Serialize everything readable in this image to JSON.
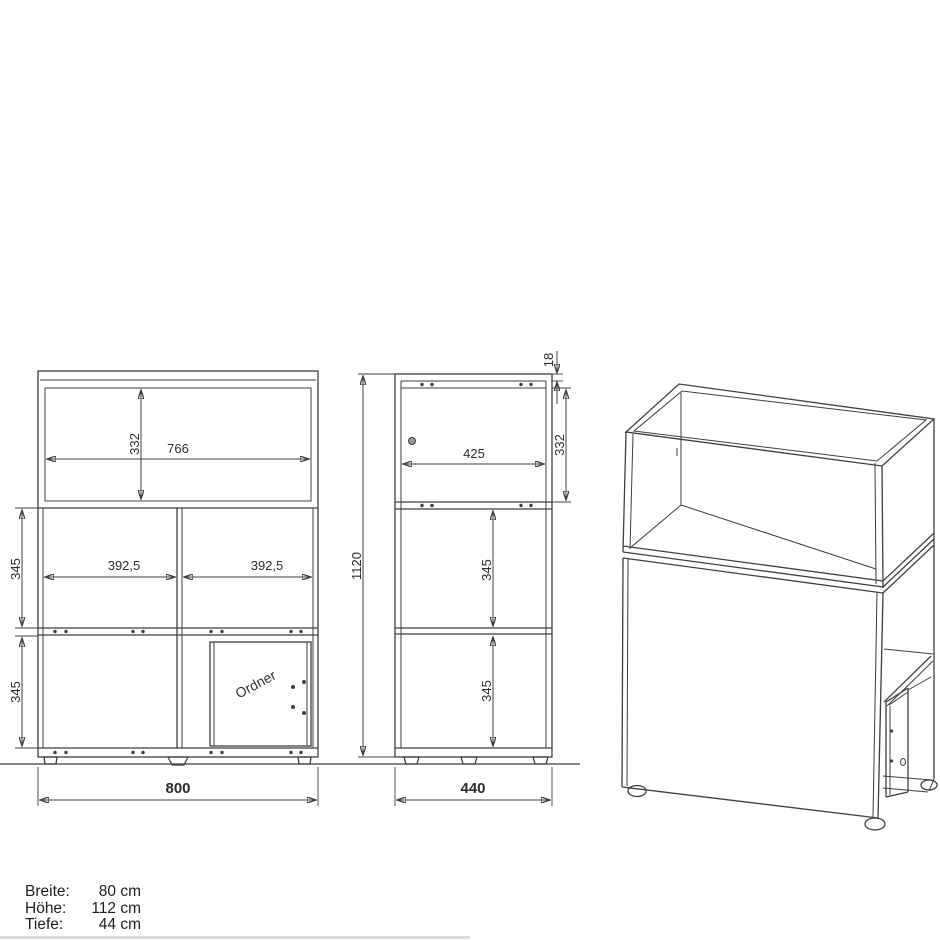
{
  "colors": {
    "line": "#3f3f3f",
    "background": "#ffffff"
  },
  "drawing": {
    "front_view": {
      "dim_inner_width": "766",
      "dim_top_inner_height": "332",
      "dim_cell_left": "392,5",
      "dim_cell_right": "392,5",
      "dim_row_middle_height": "345",
      "dim_row_bottom_height": "345",
      "dim_total_width": "800",
      "door_label": "Ordner"
    },
    "side_view": {
      "dim_top_panel_thickness": "18",
      "dim_top_inner_height": "332",
      "dim_inner_depth": "425",
      "dim_row_middle_height": "345",
      "dim_row_bottom_height": "345",
      "dim_total_height": "1120",
      "dim_total_depth": "440"
    },
    "legend": {
      "rows": [
        {
          "label": "Breite:",
          "value": "80 cm"
        },
        {
          "label": "Höhe:",
          "value": "112 cm"
        },
        {
          "label": "Tiefe:",
          "value": "44 cm"
        }
      ]
    }
  }
}
